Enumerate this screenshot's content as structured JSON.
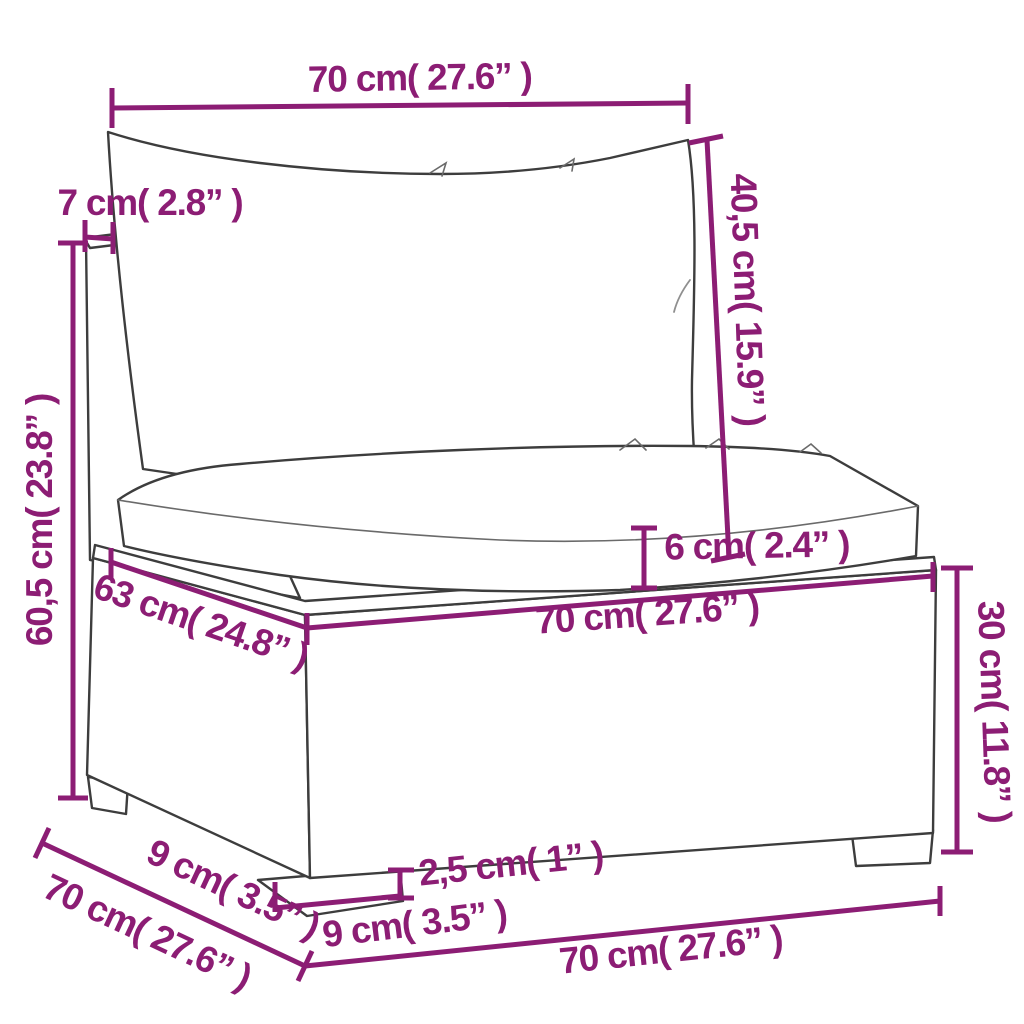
{
  "diagram": {
    "background": "#FFFFFF",
    "dimension_color": "#8C1D74",
    "line_art_color": "#3D3D3D",
    "labels": {
      "top_width": "70 cm( 27.6” )",
      "back_post_depth": "7 cm( 2.8” )",
      "backrest_height": "40,5 cm( 15.9” )",
      "total_height": "60,5 cm( 23.8” )",
      "seat_cushion_thickness": "6 cm( 2.4” )",
      "seat_width": "70 cm( 27.6” )",
      "seat_depth": "63 cm( 24.8” )",
      "base_height": "30 cm( 11.8” )",
      "bottom_depth": "70 cm( 27.6” )",
      "foot_side_width": "9 cm( 3.5” )",
      "foot_front_width": "9 cm( 3.5” )",
      "foot_height": "2,5 cm( 1” )",
      "bottom_width": "70 cm( 27.6” )"
    }
  }
}
